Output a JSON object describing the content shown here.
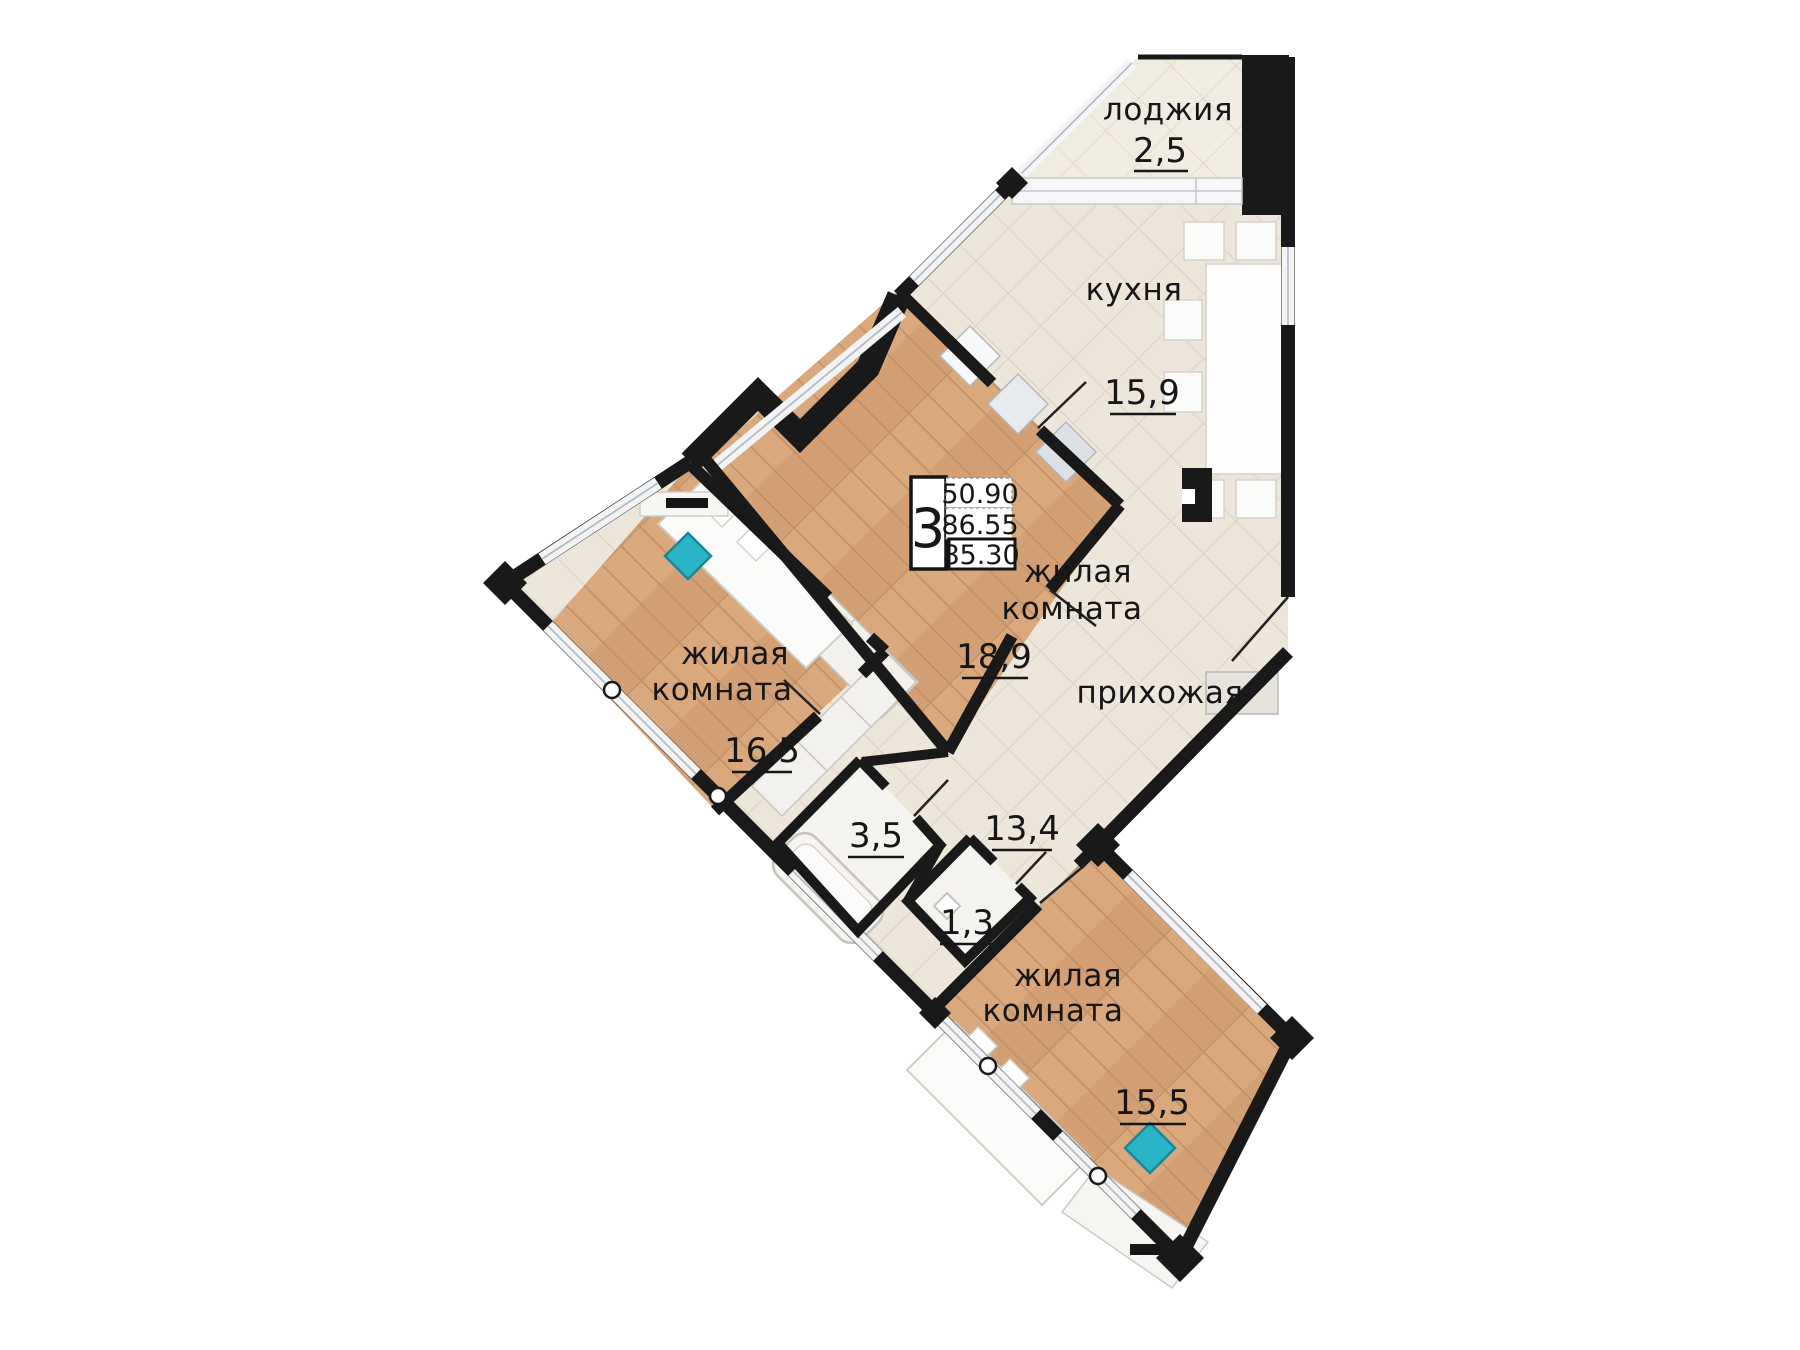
{
  "floor_plan": {
    "unit": {
      "number": "3",
      "living_area": "50.90",
      "total_area": "86.55",
      "reduced_total_area": "85.30"
    },
    "rooms": [
      {
        "id": "loggia",
        "name": "лоджия",
        "area": "2,5"
      },
      {
        "id": "kitchen",
        "name": "кухня",
        "area": "15,9"
      },
      {
        "id": "living-room-1",
        "name_line1": "жилая",
        "name_line2": "комната",
        "area": "18,9"
      },
      {
        "id": "hallway",
        "name": "прихожая",
        "area": "13,4"
      },
      {
        "id": "bathroom",
        "area": "3,5"
      },
      {
        "id": "wc",
        "area": "1,3"
      },
      {
        "id": "living-room-2",
        "name_line1": "жилая",
        "name_line2": "комната",
        "area": "16,5"
      },
      {
        "id": "living-room-3",
        "name_line1": "жилая",
        "name_line2": "комната",
        "area": "15,5"
      }
    ],
    "colors": {
      "wall": "#191919",
      "wood_floor": "#d9a87c",
      "tile_floor": "#ede6db",
      "accent_chair": "#2ab5c8",
      "window_band": "#f2f4f5"
    }
  }
}
